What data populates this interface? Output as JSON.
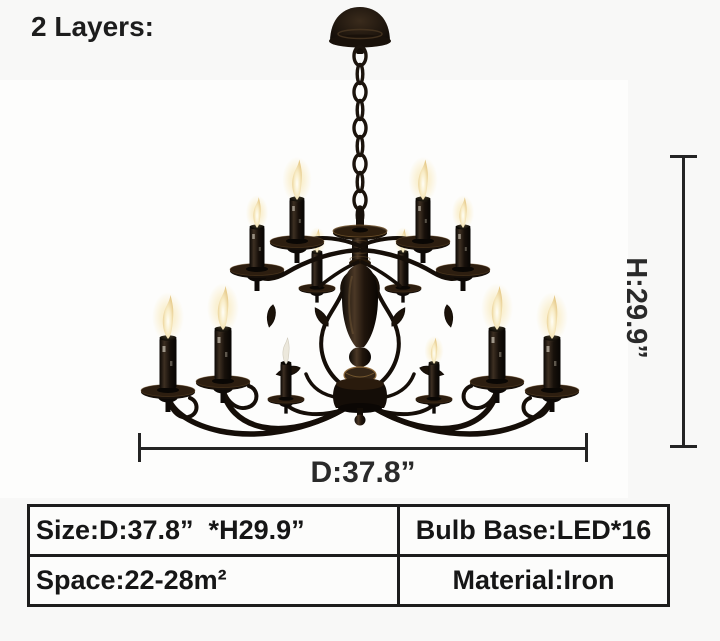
{
  "annotation": {
    "layers_label": "2 Layers:"
  },
  "dimension_lines": {
    "height": {
      "label": "H:29.9”"
    },
    "diameter": {
      "label": "D:37.8”"
    }
  },
  "spec_table": {
    "cells": {
      "size": "Size:D:37.8”  *H29.9”",
      "bulb_base": "Bulb Base:LED*16",
      "space": "Space:22-28m²",
      "material": "Material:Iron"
    }
  },
  "colors": {
    "page_background": "#f8f8f7",
    "photo_background": "#fdfdfc",
    "dimension_line": "#242424",
    "text": "#161616",
    "iron_black": "#150e08",
    "bronze_highlight": "#7a5a33",
    "flame_glow": "#f6e2a8"
  }
}
